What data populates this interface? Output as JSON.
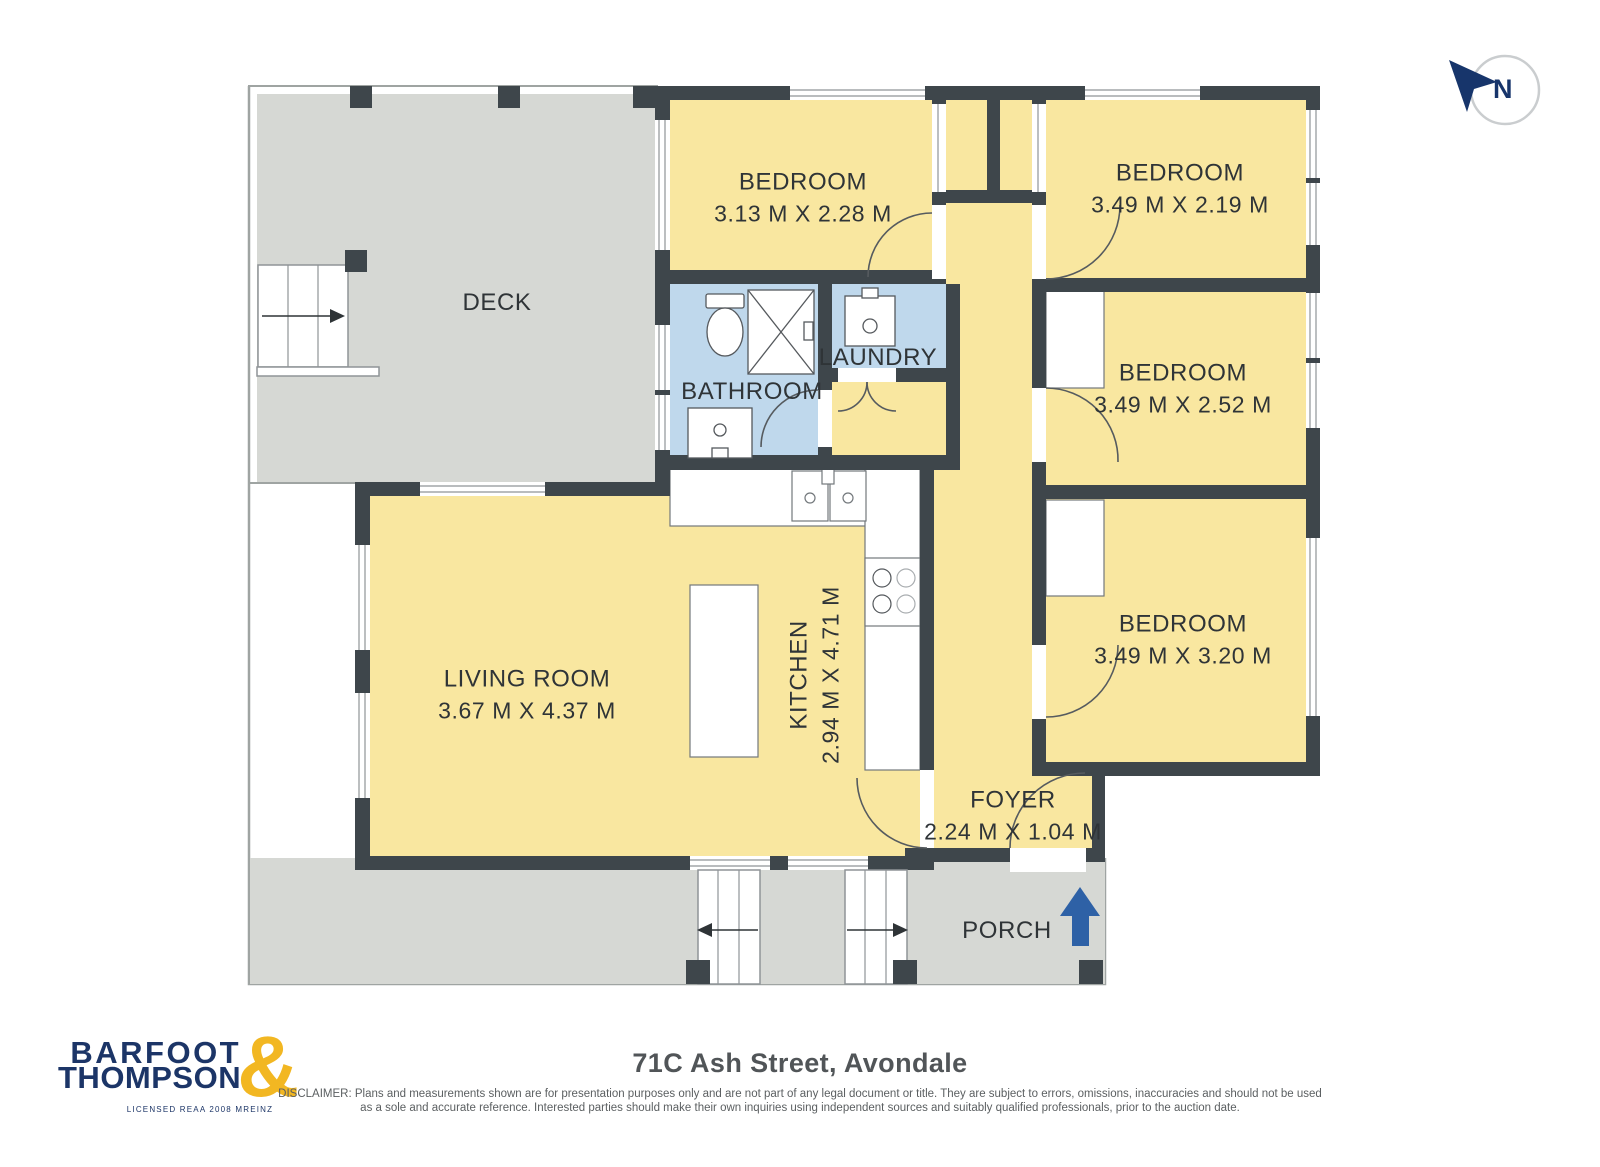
{
  "plan": {
    "rooms": [
      {
        "id": "deck",
        "name": "DECK",
        "dims": ""
      },
      {
        "id": "bedroom-1",
        "name": "BEDROOM",
        "dims": "3.13 M X 2.28 M"
      },
      {
        "id": "bedroom-2",
        "name": "BEDROOM",
        "dims": "3.49 M X 2.19 M"
      },
      {
        "id": "bedroom-3",
        "name": "BEDROOM",
        "dims": "3.49 M X 2.52 M"
      },
      {
        "id": "bedroom-4",
        "name": "BEDROOM",
        "dims": "3.49 M X 3.20 M"
      },
      {
        "id": "bathroom",
        "name": "BATHROOM",
        "dims": ""
      },
      {
        "id": "laundry",
        "name": "LAUNDRY",
        "dims": ""
      },
      {
        "id": "kitchen",
        "name": "KITCHEN",
        "dims": "2.94 M X 4.71 M"
      },
      {
        "id": "living",
        "name": "LIVING ROOM",
        "dims": "3.67 M X 4.37 M"
      },
      {
        "id": "foyer",
        "name": "FOYER",
        "dims": "2.24 M X 1.04 M"
      },
      {
        "id": "porch",
        "name": "PORCH",
        "dims": ""
      }
    ],
    "compass_label": "N",
    "colors": {
      "room_fill": "#F9E7A0",
      "wet_area_fill": "#BFD8EC",
      "deck_fill": "#D6D8D4",
      "wall": "#3E464B",
      "entry_arrow_blue": "#2E61A6",
      "compass_navy": "#17356B"
    }
  },
  "branding": {
    "name_line1": "BARFOOT",
    "name_line2": "THOMPSON",
    "ampersand": "&",
    "tagline": "LICENSED REAA 2008 MREINZ",
    "navy": "#1C3567",
    "gold": "#F2B722"
  },
  "footer": {
    "title": "71C Ash Street, Avondale",
    "disclaimer_line1": "DISCLAIMER: Plans and measurements shown are for presentation purposes only and are not part of any legal document or title. They are subject to errors, omissions, inaccuracies and should not be used",
    "disclaimer_line2": "as a sole and accurate reference. Interested parties should make their own inquiries using independent sources and suitably qualified professionals, prior to the auction date."
  }
}
